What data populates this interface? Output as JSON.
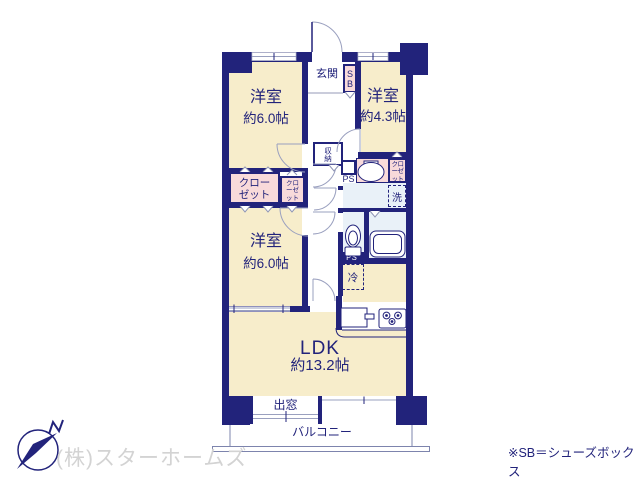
{
  "plan": {
    "rooms": {
      "bedroom_nw": {
        "name": "洋室",
        "size": "約6.0帖"
      },
      "bedroom_ne": {
        "name": "洋室",
        "size": "約4.3帖"
      },
      "bedroom_sw": {
        "name": "洋室",
        "size": "約6.0帖"
      },
      "ldk": {
        "name": "LDK",
        "size": "約13.2帖"
      }
    },
    "labels": {
      "genkan": "玄関",
      "shoe_box": "SB",
      "storage": "収納",
      "closet_large": "クローゼット",
      "closet_small": "クローゼット",
      "closet_right": "クローゼット",
      "pipe_space_upper": "PS",
      "pipe_space_lower": "PS",
      "laundry": "洗",
      "refrigerator": "冷",
      "bay_window": "出窓",
      "balcony": "バルコニー"
    }
  },
  "footer": {
    "company": "(株)スターホームズ",
    "note": "※SB＝シューズボックス"
  },
  "colors": {
    "wall_navy": "#22237b",
    "floor_cream": "#f7edcb",
    "closet_pink": "#f8dada",
    "wet_blue": "#e9f1f8",
    "line_gray": "#9aa0bf",
    "watermark_gray": "#d3d3d3"
  }
}
